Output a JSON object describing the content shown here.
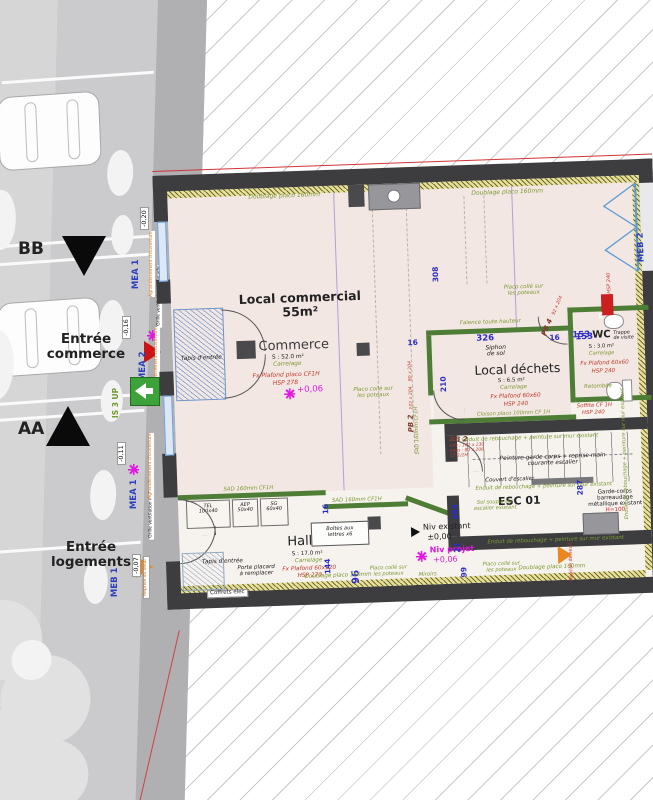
{
  "street": {
    "bb": "BB",
    "aa": "AA",
    "entree_commerce_1": "Entrée",
    "entree_commerce_2": "commerce",
    "entree_logements_1": "Entrée",
    "entree_logements_2": "logements",
    "level_020": "-0,20",
    "level_016": "-0,16",
    "level_011": "-0,11",
    "level_007": "-0,07",
    "coffret": "Coffret ECP2b",
    "mea1": "MEA 1",
    "mea2": "MEA 2",
    "meb1": "MEB 1",
    "meb2": "MEB 2",
    "grille": "Grille ventilation en façade",
    "agrandissement": "Agrandissement d'ouverture",
    "is3up": "IS 3 UP",
    "reprise_seuil": "Reprise du seuil"
  },
  "commerce": {
    "title_1": "Local commercial",
    "title_2": "55m²",
    "name": "Commerce",
    "surface": "S : 52.0 m²",
    "floor": "Carrelage",
    "ceiling_1": "Fx Plafond placo CF1H",
    "ceiling_2": "HSP 278",
    "tapis": "Tapis d'entrée"
  },
  "dechets": {
    "name": "Local déchets",
    "surface": "S : 6.5 m²",
    "floor": "Carrelage",
    "ceiling_1": "Fx Plafond 60x60",
    "ceiling_2": "HSP 240",
    "siphon_1": "Siphon",
    "siphon_2": "de sol",
    "faience": "Faïence toute hauteur"
  },
  "wc": {
    "name": "WC",
    "surface": "S : 3.0 m²",
    "floor": "Carrelage",
    "ceiling_1": "Fx Plafond 60x60",
    "ceiling_2": "HSP 240",
    "trappe_1": "Trappe",
    "trappe_2": "de visite",
    "retombee": "Retombée",
    "soffite_1": "Soffite CF 1H",
    "soffite_2": "HSP 240",
    "bl": "BL"
  },
  "hall": {
    "name": "Hall",
    "surface": "S : 17.0 m²",
    "floor": "Carrelage",
    "ceiling_1": "Fx Plafond 60x120",
    "ceiling_2": "HSP 270",
    "tapis": "Tapis d'entrée",
    "tel_1": "TEL",
    "tel_2": "100x40",
    "aep_1": "AEP",
    "aep_2": "50x40",
    "sg_1": "SG",
    "sg_2": "60x40",
    "boites_1": "Boîtes aux",
    "boites_2": "lettres x6",
    "placard_1": "Porte placard",
    "placard_2": "à remplacer",
    "coffrets": "Coffrets élec",
    "miroirs": "Miroirs"
  },
  "esc": {
    "name": "ESC 01",
    "peinture_1": "Peinture garde corps + reprise main",
    "peinture_2": "courante escalier",
    "couvert": "Couvert d'escalier",
    "sol_souple_1": "Sol souple sur",
    "sol_souple_2": "escalier existant",
    "garde_1": "Garde-corps",
    "garde_2": "barreaudage",
    "garde_3": "métallique existant",
    "h100": "H=100"
  },
  "levels": {
    "p006": "+0,06",
    "niv_exist_1": "Niv existant",
    "niv_exist_2": "±0,00",
    "niv_proj_1": "Niv projet",
    "niv_proj_2": "+0,06"
  },
  "doors": {
    "pb2": "PB 2",
    "pb2_d1": "102 x 204",
    "pb2_d2": "80 x 204",
    "pb2_d3": "CF 1/2H",
    "pb2b_d1": "vds : 102 x 230",
    "pb2b_d2": "pass : 80 x 206",
    "pb2b_d3": "CF 1/2H",
    "pb4": "PB 4",
    "pb4_d": "92 x 204"
  },
  "notes": {
    "doublage": "Doublage placo 160mm",
    "sad": "SAD 160mm CF1H",
    "cloison": "Cloison placo 100mm CF 1H",
    "enduit": "Enduit de rebouchage + peinture sur mur existant",
    "placo_1": "Placo collé sur",
    "placo_2": "les poteaux",
    "soffite_v": "Soffite HSP 240",
    "reprise_seuil": "Reprise de seuil"
  },
  "dims": {
    "d16": "16",
    "d308": "308",
    "d326": "326",
    "d153": "153",
    "d210": "210",
    "d287": "287",
    "d384": "384",
    "d144": "144",
    "d96": "96",
    "d99": "99",
    "d21": "21"
  }
}
